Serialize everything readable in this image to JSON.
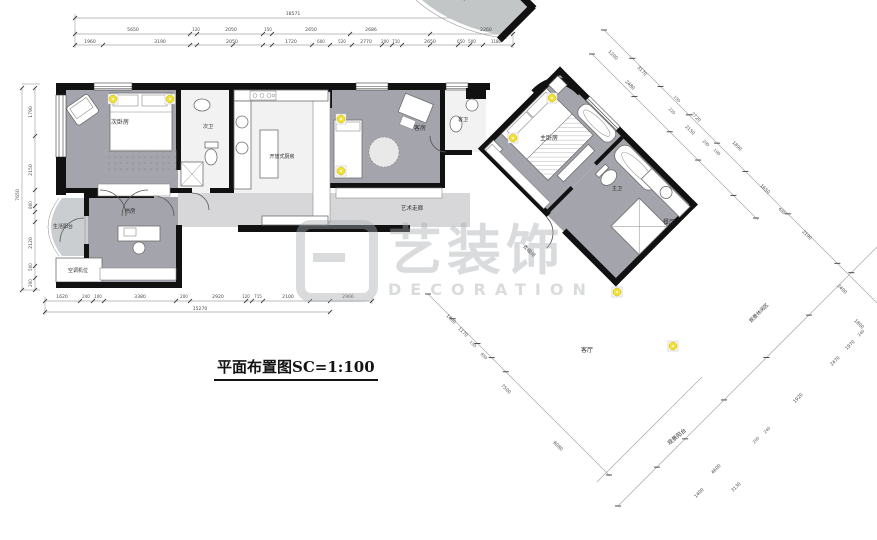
{
  "title_block": {
    "title": "平面布置图SC=1:100"
  },
  "watermark": {
    "cn": "艺装饰",
    "en": "DECORATION"
  },
  "colors": {
    "wall": "#111111",
    "room": "#a4a4ac",
    "hall": "#d7d7d9",
    "balcony": "#cbced0",
    "deck": "#c2c6c6",
    "light": "#f3e137"
  },
  "room_labels": [
    {
      "t": "次卧房",
      "x": 120,
      "y": 124,
      "s": 6
    },
    {
      "t": "次卫",
      "x": 208,
      "y": 128,
      "s": 5
    },
    {
      "t": "开放式厨房",
      "x": 282,
      "y": 158,
      "s": 5
    },
    {
      "t": "客房",
      "x": 420,
      "y": 130,
      "s": 6
    },
    {
      "t": "客卫",
      "x": 463,
      "y": 121,
      "s": 5
    },
    {
      "t": "主卧房",
      "x": 549,
      "y": 140,
      "s": 6
    },
    {
      "t": "主卫",
      "x": 617,
      "y": 190,
      "s": 5
    },
    {
      "t": "衣帽间",
      "x": 528,
      "y": 252,
      "r": 45,
      "s": 5
    },
    {
      "t": "餐厅",
      "x": 669,
      "y": 224,
      "s": 6
    },
    {
      "t": "客厅",
      "x": 587,
      "y": 352,
      "s": 6
    },
    {
      "t": "艺术走廊",
      "x": 412,
      "y": 210,
      "s": 5.5
    },
    {
      "t": "书房",
      "x": 130,
      "y": 213,
      "s": 5.5
    },
    {
      "t": "生活阳台",
      "x": 63,
      "y": 228,
      "s": 5
    },
    {
      "t": "空调机位",
      "x": 78,
      "y": 272,
      "s": 5
    },
    {
      "t": "观景休闲区",
      "x": 760,
      "y": 314,
      "r": -45,
      "s": 5
    },
    {
      "t": "观景阳台",
      "x": 678,
      "y": 438,
      "r": -40,
      "s": 5.5
    }
  ],
  "dim_labels": [
    {
      "t": "18571",
      "x": 293,
      "y": 15
    },
    {
      "t": "5650",
      "x": 133,
      "y": 31
    },
    {
      "t": "120",
      "x": 196,
      "y": 31,
      "s": 4
    },
    {
      "t": "2050",
      "x": 231,
      "y": 31
    },
    {
      "t": "150",
      "x": 268,
      "y": 31,
      "s": 4
    },
    {
      "t": "2650",
      "x": 311,
      "y": 31
    },
    {
      "t": "2686",
      "x": 371,
      "y": 31
    },
    {
      "t": "2260",
      "x": 486,
      "y": 31
    },
    {
      "t": "1960",
      "x": 90,
      "y": 43
    },
    {
      "t": "3190",
      "x": 160,
      "y": 43
    },
    {
      "t": "2050",
      "x": 232,
      "y": 43
    },
    {
      "t": "1720",
      "x": 291,
      "y": 43
    },
    {
      "t": "600",
      "x": 321,
      "y": 43,
      "s": 4
    },
    {
      "t": "520",
      "x": 342,
      "y": 43,
      "s": 4
    },
    {
      "t": "2770",
      "x": 366,
      "y": 43
    },
    {
      "t": "200",
      "x": 385,
      "y": 43,
      "s": 4
    },
    {
      "t": "710",
      "x": 396,
      "y": 43,
      "s": 4
    },
    {
      "t": "2650",
      "x": 430,
      "y": 43
    },
    {
      "t": "650",
      "x": 461,
      "y": 43,
      "s": 4
    },
    {
      "t": "500",
      "x": 472,
      "y": 43,
      "s": 4
    },
    {
      "t": "1180",
      "x": 496,
      "y": 43,
      "s": 4
    },
    {
      "t": "1790",
      "x": 32,
      "y": 112,
      "r": -90
    },
    {
      "t": "2150",
      "x": 32,
      "y": 170,
      "r": -90
    },
    {
      "t": "800",
      "x": 32,
      "y": 205,
      "r": -90,
      "s": 4
    },
    {
      "t": "2120",
      "x": 32,
      "y": 243,
      "r": -90
    },
    {
      "t": "500",
      "x": 32,
      "y": 267,
      "r": -90,
      "s": 4
    },
    {
      "t": "200",
      "x": 32,
      "y": 283,
      "r": -90,
      "s": 4
    },
    {
      "t": "7650",
      "x": 19,
      "y": 195,
      "r": -90
    },
    {
      "t": "1620",
      "x": 62,
      "y": 298
    },
    {
      "t": "240",
      "x": 86,
      "y": 298,
      "s": 4
    },
    {
      "t": "100",
      "x": 98,
      "y": 298,
      "s": 4
    },
    {
      "t": "3380",
      "x": 140,
      "y": 298
    },
    {
      "t": "200",
      "x": 184,
      "y": 298,
      "s": 4
    },
    {
      "t": "2920",
      "x": 218,
      "y": 298
    },
    {
      "t": "120",
      "x": 246,
      "y": 298,
      "s": 4
    },
    {
      "t": "715",
      "x": 258,
      "y": 298,
      "s": 4
    },
    {
      "t": "2100",
      "x": 288,
      "y": 298
    },
    {
      "t": "2966",
      "x": 348,
      "y": 298
    },
    {
      "t": "15270",
      "x": 200,
      "y": 310
    },
    {
      "t": "1200",
      "x": 612,
      "y": 56,
      "r": 45
    },
    {
      "t": "3170",
      "x": 641,
      "y": 72,
      "r": 45
    },
    {
      "t": "2480",
      "x": 629,
      "y": 86,
      "r": 45
    },
    {
      "t": "150",
      "x": 676,
      "y": 100,
      "r": 45,
      "s": 4
    },
    {
      "t": "220",
      "x": 671,
      "y": 112,
      "r": 45,
      "s": 4
    },
    {
      "t": "2720",
      "x": 695,
      "y": 118,
      "r": 45
    },
    {
      "t": "2150",
      "x": 689,
      "y": 131,
      "r": 45
    },
    {
      "t": "200",
      "x": 705,
      "y": 144,
      "r": 45,
      "s": 4
    },
    {
      "t": "100",
      "x": 716,
      "y": 153,
      "r": 45,
      "s": 4
    },
    {
      "t": "1890",
      "x": 736,
      "y": 147,
      "r": 45
    },
    {
      "t": "1650",
      "x": 764,
      "y": 190,
      "r": 45
    },
    {
      "t": "600",
      "x": 781,
      "y": 212,
      "r": 45,
      "s": 4
    },
    {
      "t": "2190",
      "x": 806,
      "y": 236,
      "r": 45
    },
    {
      "t": "2400",
      "x": 841,
      "y": 290,
      "r": 45
    },
    {
      "t": "1800",
      "x": 858,
      "y": 325,
      "r": 45
    },
    {
      "t": "1400",
      "x": 700,
      "y": 494,
      "r": -45
    },
    {
      "t": "4600",
      "x": 717,
      "y": 470,
      "r": -45
    },
    {
      "t": "3130",
      "x": 737,
      "y": 488,
      "r": -45
    },
    {
      "t": "200",
      "x": 757,
      "y": 441,
      "r": -45,
      "s": 4
    },
    {
      "t": "240",
      "x": 768,
      "y": 431,
      "r": -45,
      "s": 4
    },
    {
      "t": "1920",
      "x": 799,
      "y": 399,
      "r": -45
    },
    {
      "t": "2470",
      "x": 836,
      "y": 362,
      "r": -45
    },
    {
      "t": "1970",
      "x": 851,
      "y": 346,
      "r": -45
    },
    {
      "t": "240",
      "x": 862,
      "y": 334,
      "r": -45,
      "s": 4
    },
    {
      "t": "1400",
      "x": 450,
      "y": 320,
      "r": 45
    },
    {
      "t": "1170",
      "x": 462,
      "y": 333,
      "r": 45
    },
    {
      "t": "150",
      "x": 472,
      "y": 345,
      "r": 45,
      "s": 4
    },
    {
      "t": "850",
      "x": 483,
      "y": 357,
      "r": 45,
      "s": 4
    },
    {
      "t": "7500",
      "x": 505,
      "y": 390,
      "r": 45
    },
    {
      "t": "6080",
      "x": 557,
      "y": 447,
      "r": 45
    }
  ]
}
